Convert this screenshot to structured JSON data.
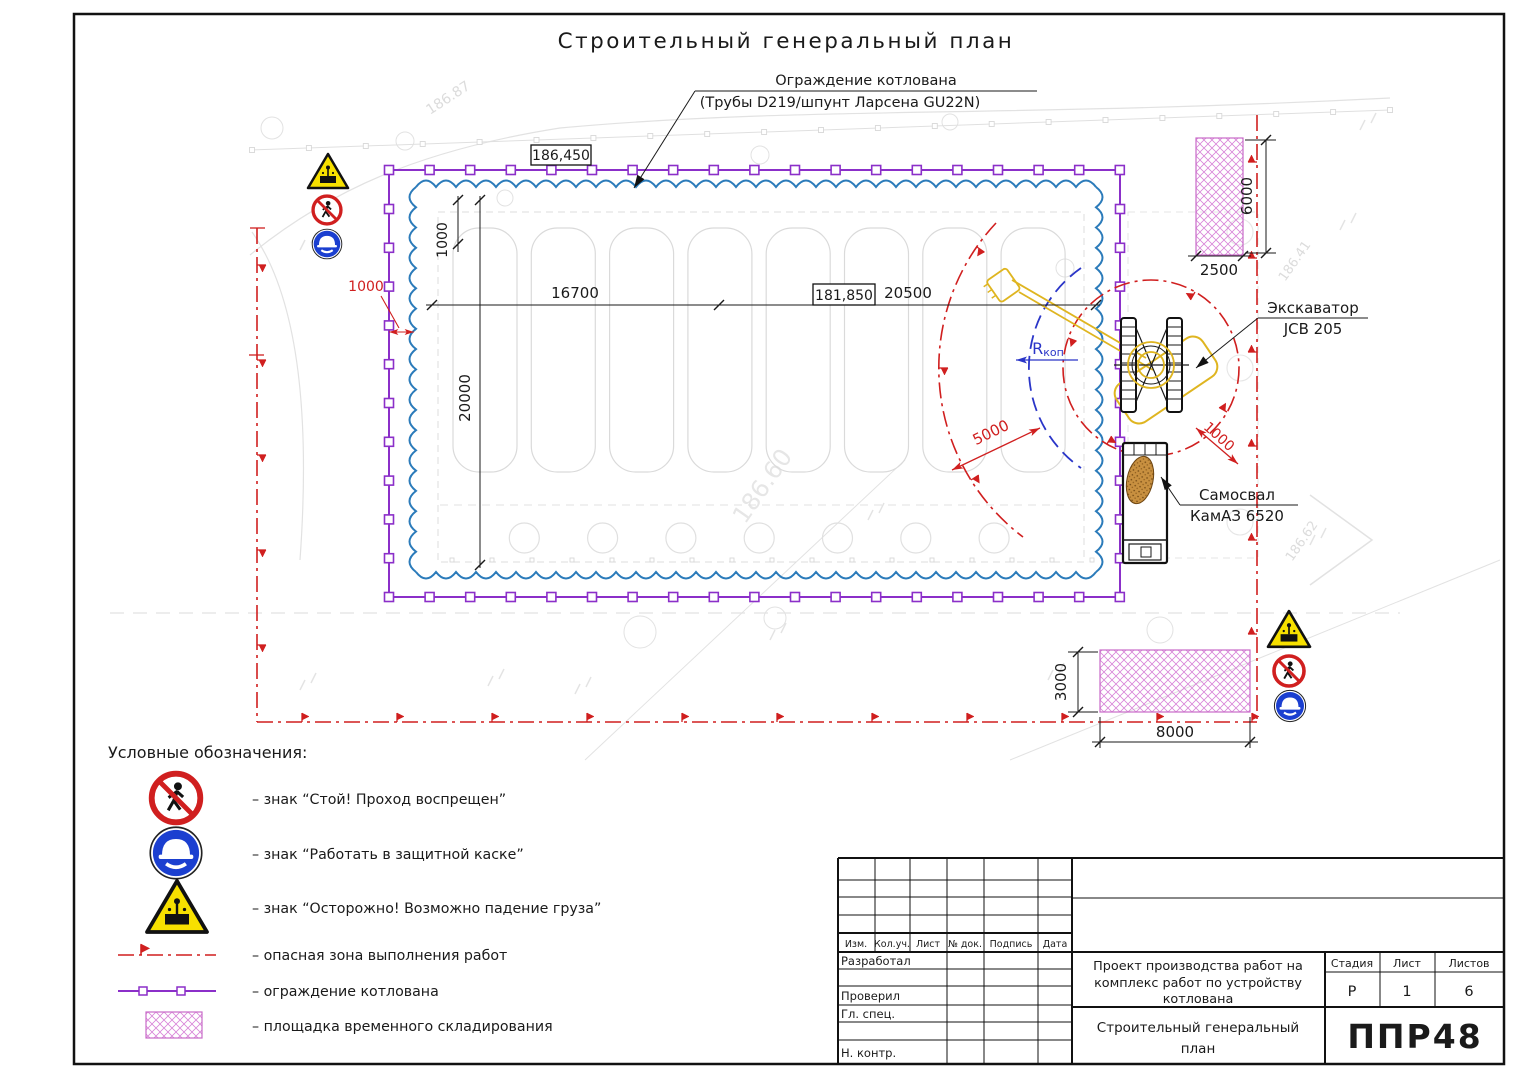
{
  "drawing": {
    "title": "Строительный генеральный план",
    "fence_callout": {
      "line1": "Ограждение котлована",
      "line2": "(Трубы D219/шпунт Ларсена GU22N)"
    },
    "excavator_callout": {
      "line1": "Экскаватор",
      "line2": "JCB 205"
    },
    "truck_callout": {
      "line1": "Самосвал",
      "line2": "КамАЗ 6520"
    },
    "radius_label": {
      "symbol": "R",
      "subscript": "коп"
    },
    "elevations": {
      "fence_top": "186,450",
      "pit_bottom": "181,850"
    },
    "dimensions": {
      "offset_top": "1000",
      "pit_width": "16700",
      "pit_total": "20500",
      "pit_height": "20000",
      "storage_top_width": "2500",
      "storage_top_height": "6000",
      "storage_bottom_height": "3000",
      "storage_bottom_width": "8000",
      "danger_radius": "5000",
      "fence_offset": "1000",
      "excavator_clearance": "1000"
    },
    "background_marks": {
      "contour_a": "186.87",
      "contour_b": "186.41",
      "contour_c": "186.62",
      "contour_d": "186.60"
    }
  },
  "legend": {
    "heading": "Условные обозначения:",
    "items": [
      {
        "label": "– знак “Стой! Проход воспрещен”"
      },
      {
        "label": "– знак “Работать в защитной каске”"
      },
      {
        "label": "– знак “Осторожно! Возможно падение груза”"
      },
      {
        "label": "– опасная зона выполнения работ"
      },
      {
        "label": "– ограждение котлована"
      },
      {
        "label": "– площадка временного складирования"
      }
    ]
  },
  "title_block": {
    "revision_headers": [
      "Изм.",
      "Кол.уч.",
      "Лист",
      "№ док.",
      "Подпись",
      "Дата"
    ],
    "role_labels": [
      "Разработал",
      "Проверил",
      "Гл. спец.",
      "Н. контр."
    ],
    "project_lines": [
      "Проект производства работ на",
      "комплекс работ по устройству",
      "котлована"
    ],
    "sheet_title_lines": [
      "Строительный генеральный",
      "план"
    ],
    "stage_header": "Стадия",
    "sheet_header": "Лист",
    "sheets_header": "Листов",
    "stage": "Р",
    "sheet_number": "1",
    "sheet_total": "6",
    "logo": "ППР48"
  },
  "colors": {
    "fence": "#8b2fc9",
    "sheet_pile": "#2b7bba",
    "danger_zone": "#d01f1f",
    "dig_radius": "#2a35c8",
    "machine_yellow": "#dfb520",
    "storage_hatch": "#d884d8",
    "logo_green": "#2aa546",
    "sign_red": "#d01f1f",
    "sign_blue": "#1b3fd0",
    "sign_yellow": "#f7e000"
  }
}
